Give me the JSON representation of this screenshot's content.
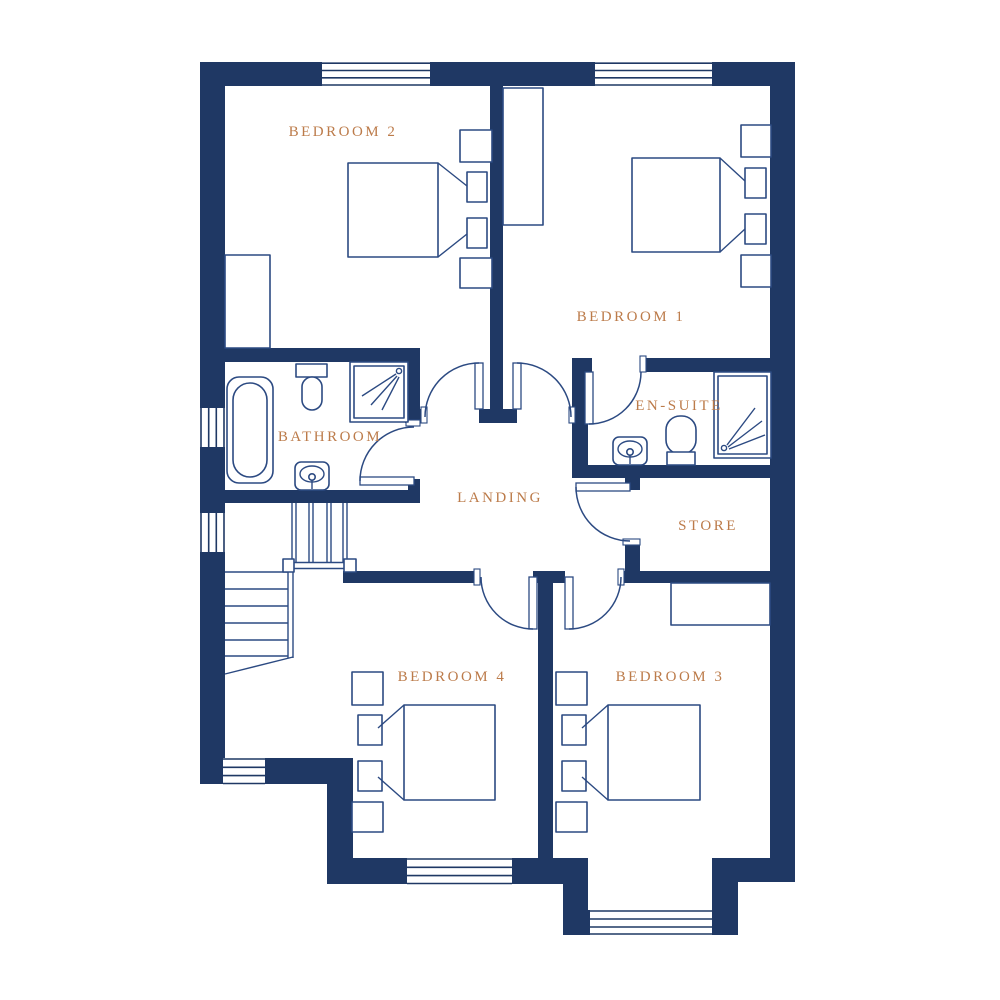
{
  "colors": {
    "wall": "#1f3864",
    "line": "#2c4a82",
    "label": "#bc7b4a",
    "background": "#ffffff"
  },
  "rooms": {
    "bedroom2": {
      "label": "BEDROOM 2"
    },
    "bedroom1": {
      "label": "BEDROOM 1"
    },
    "bathroom": {
      "label": "BATHROOM"
    },
    "ensuite": {
      "label": "EN-SUITE"
    },
    "landing": {
      "label": "LANDING"
    },
    "store": {
      "label": "STORE"
    },
    "bedroom4": {
      "label": "BEDROOM 4"
    },
    "bedroom3": {
      "label": "BEDROOM 3"
    }
  }
}
